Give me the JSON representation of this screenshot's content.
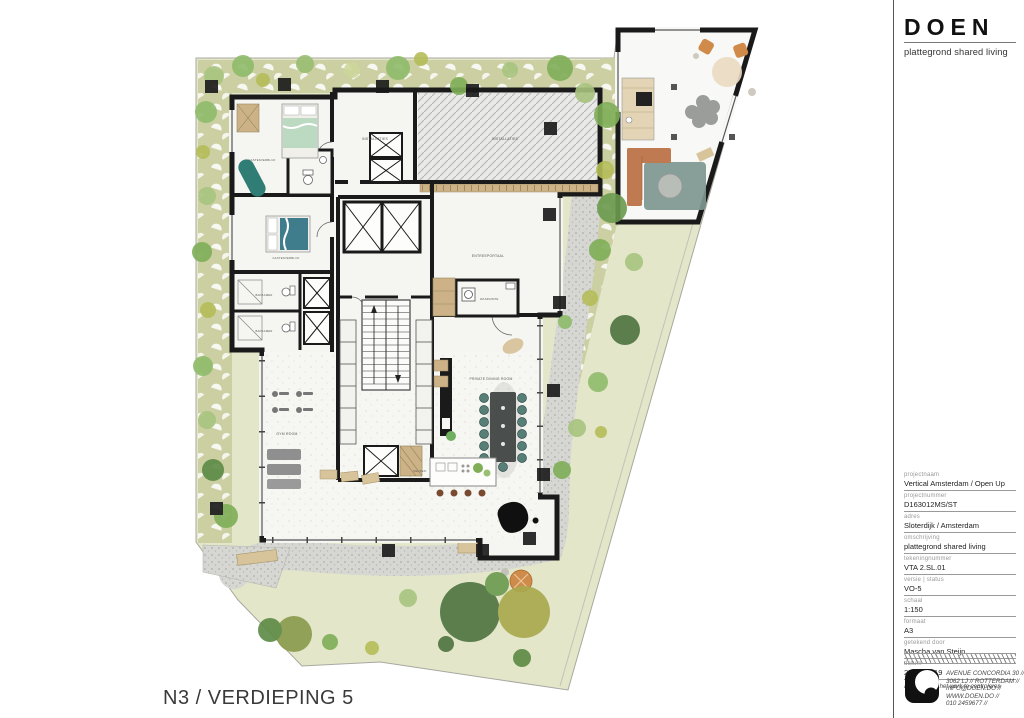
{
  "header": {
    "logo": "DOEN",
    "subtitle": "plattegrond shared living"
  },
  "titleblock": {
    "fields": [
      {
        "label": "projectnaam",
        "value": "Vertical Amsterdam / Open Up"
      },
      {
        "label": "projectnummer",
        "value": "D163012MS/ST"
      },
      {
        "label": "adres",
        "value": "Sloterdijk / Amsterdam"
      },
      {
        "label": "omschrijving",
        "value": "plattegrond shared living"
      },
      {
        "label": "tekeningnummer",
        "value": "VTA 2.SL.01"
      },
      {
        "label": "versie | status",
        "value": "VO-5"
      },
      {
        "label": "schaal",
        "value": "1:150"
      },
      {
        "label": "formaat",
        "value": "A3"
      },
      {
        "label": "getekend door",
        "value": "Mascha van Steijn"
      },
      {
        "label": "datum",
        "value": "27-05-2019"
      }
    ],
    "note": "alle maten in het werk te controleren"
  },
  "contact": {
    "lines": [
      "AVENUE CONCORDIA 30 //",
      "3062 LJ //  ROTTERDAM //",
      "INFO@DOEN.DO //",
      "WWW.DOEN.DO //",
      "010 2459677 //"
    ]
  },
  "drawing": {
    "title": "N3 / VERDIEPING 5"
  },
  "plan": {
    "rooms": [
      "GASTENVERBLIJF",
      "INSTALLATIES",
      "INSTALLATIES",
      "ENTREEPORTAAL",
      "WASRUIMTE",
      "GASTENVERBLIJF",
      "BADKAMER",
      "BADKAMER",
      "GYM ROOM",
      "PRIVATE DINING ROOM",
      "KEUKEN"
    ],
    "colors": {
      "wall": "#1a1a1a",
      "garden_band": "#cbcfa2",
      "lawn": "#e3e6c8",
      "paving": "#d6d6d3",
      "tree_green": "#7fae57",
      "tree_olive": "#b5bd58",
      "tree_dark": "#4e7340",
      "chair_teal": "#577f78",
      "sofa_terracotta": "#c07a52",
      "wood": "#cdb288"
    }
  }
}
